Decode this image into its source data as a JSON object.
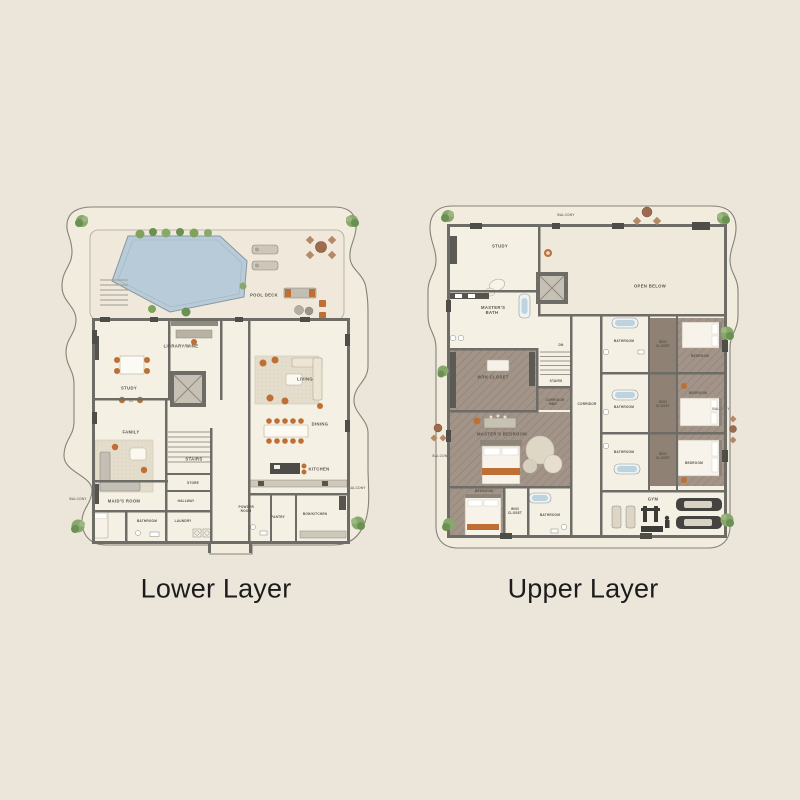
{
  "captions": {
    "lower": "Lower Layer",
    "upper": "Upper Layer"
  },
  "palette": {
    "background": "#ece5da",
    "floor": "#f3efe3",
    "wall": "#6e6c66",
    "bedroom_floor": "#a29488",
    "pool_water": "#b7ccd8",
    "accent_furniture": "#bf6f33",
    "plants": "#7fa35f",
    "label_text": "#57534b",
    "caption_text": "#1c1c1c"
  },
  "lower_plan": {
    "labels": {
      "pool_deck": "POOL DECK",
      "balcony_left": "BALCONY",
      "balcony_right": "BALCONY",
      "study": "STUDY",
      "library_wine": "LIBRARY/WINE",
      "living": "LIVING",
      "family": "FAMILY",
      "dining": "DINING",
      "kitchen": "KITCHEN",
      "stairs": "STAIRS",
      "store": "STORE",
      "hallway": "HALLWAY",
      "laundry": "LAUNDRY",
      "bathroom": "BATHROOM",
      "maids_room": "MAID'S ROOM",
      "powder_room": "POWDER ROOM",
      "pantry": "PANTRY",
      "boh_kitchen": "BOH/KITCHEN"
    }
  },
  "upper_plan": {
    "labels": {
      "balcony_top": "BALCONY",
      "balcony_left": "BALCONY",
      "balcony_right": "BALCONY",
      "study": "STUDY",
      "masters_bath": "MASTER'S BATH",
      "open_below": "OPEN BELOW",
      "win_closet_master": "W/IN CLOSET",
      "masters_bedroom": "MASTER'S BEDROOM",
      "corridor_mbr": "CORRIDOR MBR",
      "corridor": "CORRIDOR",
      "stairs": "STAIRS",
      "dn": "DN",
      "bathroom_1": "BATHROOM",
      "win_closet_1": "W/IN CLOSET",
      "bedroom_1": "BEDROOM",
      "bathroom_2": "BATHROOM",
      "win_closet_2": "W/IN CLOSET",
      "bedroom_2": "BEDROOM",
      "bathroom_3": "BATHROOM",
      "win_closet_3": "W/IN CLOSET",
      "bedroom_3": "BEDROOM",
      "bedroom_4": "BEDROOM",
      "win_closet_4": "W/IN CLOSET",
      "bathroom_4": "BATHROOM",
      "gym": "GYM",
      "balcony_left2": "BALCONY",
      "balcony_right2": "BALCONY"
    }
  }
}
